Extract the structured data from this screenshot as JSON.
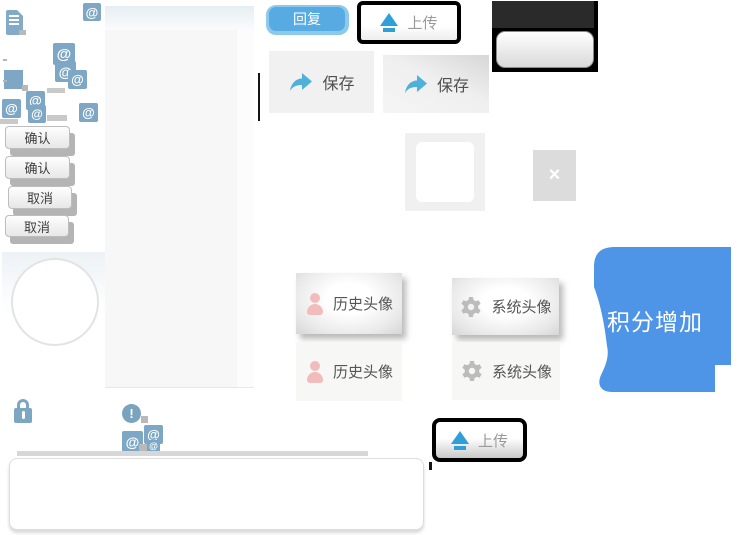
{
  "labels": {
    "reply": "回复",
    "upload": "上传",
    "save": "保存",
    "confirm": "确认",
    "cancel": "取消",
    "history_avatar": "历史头像",
    "system_avatar": "系统头像",
    "points_increase": "积分增加",
    "close": "×",
    "at": "@",
    "alert": "!"
  },
  "colors": {
    "steel_blue": "#7da7c4",
    "reply_fill": "#57abe2",
    "reply_ring": "#8ccaec",
    "action_blue": "#2f9fda",
    "save_arrow_blue": "#4fb0da",
    "bubble_blue": "#4e94e7",
    "person_pink": "#f3bcbc",
    "gear_gray": "#bcbcbc",
    "toolbar_black": "#000000",
    "button_text": "#3f3f3f"
  },
  "icons": [
    "doc-icon",
    "at-icon",
    "upload-icon",
    "share-icon",
    "person-icon",
    "gear-icon",
    "lock-icon",
    "alert-icon",
    "close-icon"
  ]
}
